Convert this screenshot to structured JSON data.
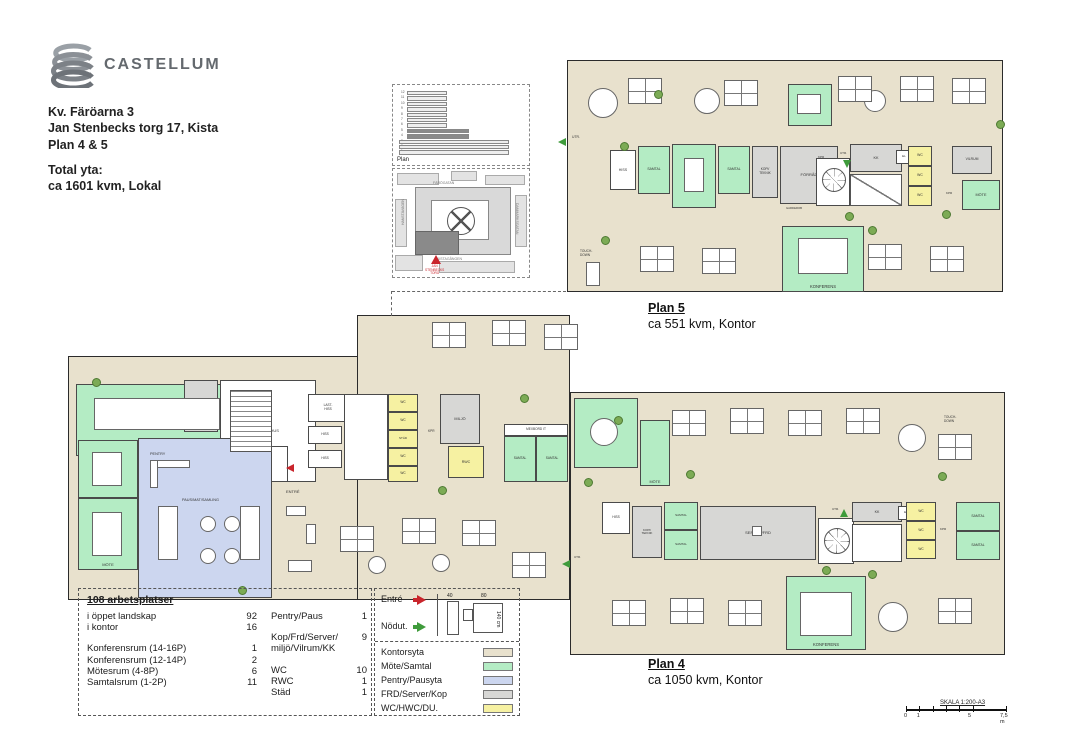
{
  "brand": {
    "name": "CASTELLUM"
  },
  "header": {
    "line1": "Kv. Färöarna 3",
    "line2": "Jan Stenbecks torg 17, Kista",
    "line3": "Plan 4 & 5",
    "total_label": "Total yta:",
    "total_value": "ca 1601 kvm, Lokal"
  },
  "palette": {
    "kontor": "#e8e1cd",
    "mote": "#b4ecc4",
    "pentry": "#ccd6ef",
    "frd": "#d7d7d5",
    "wc": "#f6f1a2",
    "white": "#ffffff",
    "wall": "#2b2b2b",
    "roomline": "#4a4a4a",
    "plant": "#7cab55",
    "red": "#c9252c",
    "green": "#3f9b3b"
  },
  "site": {
    "elevation_label": "Plan",
    "floors": [
      "12",
      "11",
      "10",
      "9",
      "8",
      "7",
      "6",
      "5",
      "4",
      "3",
      "2",
      "1"
    ],
    "streets": {
      "top": "FÄRÖGATAN",
      "bottom": "KISTAGÅNGEN",
      "left": "HANSTAVÄGEN",
      "right": "DANMARKSGATAN"
    },
    "marker": "JAN\nSTENBECKS\nTORG"
  },
  "plan5": {
    "title": "Plan 5",
    "subtitle": "ca 551 kvm, Kontor",
    "shapes": [
      [
        567,
        60,
        436,
        232,
        "kontor"
      ]
    ],
    "dashes": [],
    "rooms": [
      [
        788,
        84,
        44,
        42,
        "mote",
        "MÖTE",
        4
      ],
      [
        610,
        150,
        26,
        40,
        "white",
        "HISS",
        3.6
      ],
      [
        638,
        146,
        32,
        48,
        "mote",
        "SAMTAL",
        3.4
      ],
      [
        672,
        144,
        44,
        64,
        "mote",
        "MÖTE",
        4
      ],
      [
        718,
        146,
        32,
        48,
        "mote",
        "SAMTAL",
        3.4
      ],
      [
        752,
        146,
        26,
        52,
        "frd",
        "KOPI/\nTEKNIK",
        3.2
      ],
      [
        780,
        146,
        58,
        58,
        "frd",
        "FÖRRÅD",
        4
      ],
      [
        850,
        144,
        52,
        28,
        "frd",
        "KK",
        3.8
      ],
      [
        896,
        150,
        16,
        14,
        "white",
        "EL",
        3
      ],
      [
        908,
        146,
        24,
        20,
        "wc",
        "WC",
        3.4
      ],
      [
        908,
        166,
        24,
        20,
        "wc",
        "WC",
        3.4
      ],
      [
        908,
        186,
        24,
        20,
        "wc",
        "WC",
        3.4
      ],
      [
        952,
        146,
        40,
        28,
        "frd",
        "VILRUM",
        3.4
      ],
      [
        962,
        180,
        38,
        30,
        "mote",
        "MÖTE",
        3.8
      ],
      [
        782,
        226,
        82,
        66,
        "mote",
        "KONFERENS",
        4.2,
        "b"
      ],
      [
        816,
        158,
        34,
        48,
        "white",
        "",
        0
      ]
    ],
    "furn": [
      [
        798,
        238,
        50,
        36,
        "rect"
      ],
      [
        684,
        158,
        20,
        34,
        "rect"
      ],
      [
        797,
        94,
        24,
        20,
        "rect"
      ],
      [
        588,
        88,
        30,
        30,
        "round"
      ],
      [
        694,
        88,
        26,
        26,
        "round"
      ],
      [
        864,
        90,
        22,
        22,
        "round"
      ],
      [
        822,
        168,
        24,
        24,
        "spiral"
      ],
      [
        850,
        174,
        52,
        32,
        "diag"
      ],
      [
        628,
        78,
        0,
        0,
        "cluster"
      ],
      [
        724,
        80,
        0,
        0,
        "cluster"
      ],
      [
        838,
        76,
        0,
        0,
        "cluster"
      ],
      [
        900,
        76,
        0,
        0,
        "cluster"
      ],
      [
        952,
        78,
        0,
        0,
        "cluster"
      ],
      [
        640,
        246,
        0,
        0,
        "cluster"
      ],
      [
        702,
        248,
        0,
        0,
        "cluster"
      ],
      [
        868,
        244,
        0,
        0,
        "cluster"
      ],
      [
        930,
        246,
        0,
        0,
        "cluster"
      ],
      [
        586,
        262,
        14,
        24,
        "rect"
      ]
    ],
    "texts": [
      [
        572,
        136,
        "UTR.",
        3.4
      ],
      [
        818,
        156,
        "KPR",
        3
      ],
      [
        840,
        152,
        "UTR.",
        3
      ],
      [
        946,
        192,
        "KPR",
        3
      ],
      [
        786,
        207,
        "GARDEROB",
        2.8
      ],
      [
        580,
        250,
        "TOUCH-\nDOWN",
        3.2
      ]
    ],
    "arrows": [
      [
        558,
        138,
        "left",
        "green"
      ],
      [
        843,
        160,
        "down",
        "green"
      ]
    ],
    "plants": [
      [
        620,
        142
      ],
      [
        654,
        90
      ],
      [
        845,
        212
      ],
      [
        868,
        226
      ],
      [
        942,
        210
      ],
      [
        601,
        236
      ],
      [
        996,
        120
      ]
    ]
  },
  "plan4": {
    "title": "Plan 4",
    "subtitle": "ca 1050 kvm, Kontor",
    "shapes": [
      [
        68,
        356,
        352,
        244,
        "kontor"
      ],
      [
        357,
        315,
        213,
        285,
        "kontor"
      ],
      [
        570,
        392,
        435,
        263,
        "kontor"
      ]
    ],
    "dashes": [
      [
        392,
        291,
        174,
        "h"
      ],
      [
        391,
        291,
        25,
        "v"
      ]
    ],
    "rooms": [
      [
        76,
        384,
        162,
        72,
        "mote",
        "KONFERENS",
        4.2,
        "b"
      ],
      [
        184,
        380,
        34,
        52,
        "frd",
        "FÖRRÅD",
        3.2
      ],
      [
        220,
        380,
        96,
        102,
        "white",
        "TRAPPHUS",
        4
      ],
      [
        232,
        446,
        56,
        36,
        "white",
        "ELC",
        3.8
      ],
      [
        78,
        440,
        60,
        58,
        "mote",
        "MÖTE",
        4
      ],
      [
        78,
        498,
        60,
        72,
        "mote",
        "MÖTE",
        4,
        "b"
      ],
      [
        138,
        438,
        134,
        160,
        "pentry",
        "",
        0
      ],
      [
        308,
        394,
        40,
        28,
        "white",
        "LAST-\nHISS",
        3.2
      ],
      [
        308,
        426,
        34,
        18,
        "white",
        "HISS",
        3.2
      ],
      [
        308,
        450,
        34,
        18,
        "white",
        "HISS",
        3.2
      ],
      [
        344,
        394,
        44,
        86,
        "white",
        "",
        0
      ],
      [
        388,
        394,
        30,
        18,
        "wc",
        "WC",
        3.2
      ],
      [
        388,
        412,
        30,
        18,
        "wc",
        "WC",
        3.2
      ],
      [
        388,
        430,
        30,
        18,
        "wc",
        "STÄD",
        3
      ],
      [
        388,
        448,
        30,
        18,
        "wc",
        "WC",
        3.2
      ],
      [
        388,
        466,
        30,
        16,
        "wc",
        "WC",
        3.2
      ],
      [
        440,
        394,
        40,
        50,
        "frd",
        "MILJÖ",
        3.8
      ],
      [
        448,
        446,
        36,
        32,
        "wc",
        "RWC",
        3.6
      ],
      [
        504,
        424,
        64,
        12,
        "white",
        "MEXBORD IT",
        3.2
      ],
      [
        504,
        436,
        32,
        46,
        "mote",
        "SAMTAL",
        3.2
      ],
      [
        536,
        436,
        32,
        46,
        "mote",
        "SAMTAL",
        3.2
      ],
      [
        574,
        398,
        64,
        70,
        "mote",
        "MÖTE",
        4
      ],
      [
        640,
        420,
        30,
        66,
        "mote",
        "MÖTE",
        3.8,
        "b"
      ],
      [
        602,
        502,
        28,
        32,
        "white",
        "HISS",
        3.2
      ],
      [
        632,
        506,
        30,
        52,
        "frd",
        "KOPI/\nTEKNIK",
        3
      ],
      [
        664,
        502,
        34,
        28,
        "mote",
        "SAMTAL",
        3
      ],
      [
        664,
        530,
        34,
        30,
        "mote",
        "SAMTAL",
        3
      ],
      [
        700,
        506,
        116,
        54,
        "frd",
        "SERVER/FRD",
        4
      ],
      [
        818,
        518,
        36,
        46,
        "white",
        "",
        0
      ],
      [
        852,
        502,
        50,
        20,
        "frd",
        "KK",
        3.6
      ],
      [
        852,
        524,
        50,
        38,
        "white",
        "",
        0
      ],
      [
        898,
        506,
        16,
        14,
        "white",
        "EL",
        3
      ],
      [
        906,
        502,
        30,
        19,
        "wc",
        "WC",
        3.2
      ],
      [
        906,
        521,
        30,
        19,
        "wc",
        "WC",
        3.2
      ],
      [
        906,
        540,
        30,
        19,
        "wc",
        "WC",
        3.2
      ],
      [
        956,
        502,
        44,
        29,
        "mote",
        "SAMTAL",
        3.4
      ],
      [
        956,
        531,
        44,
        29,
        "mote",
        "SAMTAL",
        3.4
      ],
      [
        786,
        576,
        80,
        74,
        "mote",
        "KONFERENS",
        4.2,
        "b"
      ]
    ],
    "furn": [
      [
        94,
        398,
        126,
        32,
        "rect"
      ],
      [
        92,
        452,
        30,
        34,
        "rect"
      ],
      [
        92,
        512,
        30,
        44,
        "rect"
      ],
      [
        230,
        390,
        42,
        62,
        "stair"
      ],
      [
        150,
        460,
        40,
        8,
        "rect"
      ],
      [
        150,
        460,
        8,
        28,
        "rect"
      ],
      [
        158,
        506,
        20,
        54,
        "rect"
      ],
      [
        240,
        506,
        20,
        54,
        "rect"
      ],
      [
        200,
        516,
        16,
        16,
        "round"
      ],
      [
        224,
        516,
        16,
        16,
        "round"
      ],
      [
        200,
        548,
        16,
        16,
        "round"
      ],
      [
        224,
        548,
        16,
        16,
        "round"
      ],
      [
        286,
        506,
        20,
        10,
        "rect"
      ],
      [
        306,
        524,
        10,
        20,
        "rect"
      ],
      [
        288,
        560,
        24,
        12,
        "rect"
      ],
      [
        432,
        322,
        0,
        0,
        "cluster"
      ],
      [
        492,
        320,
        0,
        0,
        "cluster"
      ],
      [
        544,
        324,
        0,
        0,
        "cluster"
      ],
      [
        340,
        526,
        0,
        0,
        "cluster"
      ],
      [
        402,
        518,
        0,
        0,
        "cluster"
      ],
      [
        462,
        520,
        0,
        0,
        "cluster"
      ],
      [
        512,
        552,
        0,
        0,
        "cluster"
      ],
      [
        368,
        556,
        18,
        18,
        "round"
      ],
      [
        432,
        554,
        18,
        18,
        "round"
      ],
      [
        590,
        418,
        28,
        28,
        "round"
      ],
      [
        672,
        410,
        0,
        0,
        "cluster"
      ],
      [
        730,
        408,
        0,
        0,
        "cluster"
      ],
      [
        788,
        410,
        0,
        0,
        "cluster"
      ],
      [
        846,
        408,
        0,
        0,
        "cluster"
      ],
      [
        898,
        424,
        28,
        28,
        "round"
      ],
      [
        938,
        434,
        0,
        0,
        "cluster"
      ],
      [
        824,
        528,
        26,
        26,
        "spiral"
      ],
      [
        752,
        526,
        10,
        10,
        "rect"
      ],
      [
        800,
        592,
        52,
        44,
        "rect"
      ],
      [
        612,
        600,
        0,
        0,
        "cluster"
      ],
      [
        670,
        598,
        0,
        0,
        "cluster"
      ],
      [
        728,
        600,
        0,
        0,
        "cluster"
      ],
      [
        938,
        598,
        0,
        0,
        "cluster"
      ],
      [
        878,
        602,
        30,
        30,
        "round"
      ]
    ],
    "texts": [
      [
        150,
        452,
        "PENTRY",
        3.8
      ],
      [
        182,
        498,
        "PAUS/MAT/SAMLING",
        3.8
      ],
      [
        286,
        490,
        "ENTRÉ",
        4
      ],
      [
        428,
        430,
        "KPR",
        3.2
      ],
      [
        832,
        508,
        "UTR.",
        3
      ],
      [
        940,
        528,
        "KPR",
        3
      ],
      [
        574,
        556,
        "UTR.",
        3
      ],
      [
        944,
        416,
        "TOUCH-\nDOWN",
        3.2
      ]
    ],
    "arrows": [
      [
        286,
        464,
        "left",
        "red"
      ],
      [
        840,
        509,
        "up",
        "green"
      ],
      [
        562,
        560,
        "left",
        "green"
      ]
    ],
    "plants": [
      [
        92,
        378
      ],
      [
        238,
        586
      ],
      [
        438,
        486
      ],
      [
        520,
        394
      ],
      [
        584,
        478
      ],
      [
        686,
        470
      ],
      [
        822,
        566
      ],
      [
        868,
        570
      ],
      [
        938,
        472
      ],
      [
        614,
        416
      ]
    ]
  },
  "stats": {
    "title": "108 arbetsplatser",
    "left_rows": [
      {
        "label": "i öppet landskap",
        "value": "92"
      },
      {
        "label": "i kontor",
        "value": "16"
      },
      null,
      {
        "label": "Konferensrum (14-16P)",
        "value": "1"
      },
      {
        "label": "Konferensrum (12-14P)",
        "value": "2"
      },
      {
        "label": "Mötesrum (4-8P)",
        "value": "6"
      },
      {
        "label": "Samtalsrum (1-2P)",
        "value": "11"
      }
    ],
    "right_rows": [
      {
        "label": "Pentry/Paus",
        "value": "1"
      },
      null,
      {
        "label": "Kop/Frd/Server/\nmiljö/Vilrum/KK",
        "value": "9"
      },
      null,
      {
        "label": "WC",
        "value": "10"
      },
      {
        "label": "RWC",
        "value": "1"
      },
      {
        "label": "Städ",
        "value": "1"
      }
    ]
  },
  "legend": {
    "entre_label": "Entré",
    "nodut_label": "Nödut.",
    "door_dims": {
      "w1": "40",
      "w2": "80",
      "h": "140 cm"
    },
    "colors": [
      {
        "label": "Kontorsyta",
        "key": "kontor"
      },
      {
        "label": "Möte/Samtal",
        "key": "mote"
      },
      {
        "label": "Pentry/Pausyta",
        "key": "pentry"
      },
      {
        "label": "FRD/Server/Kop",
        "key": "frd"
      },
      {
        "label": "WC/HWC/DU.",
        "key": "wc"
      }
    ]
  },
  "scalebar": {
    "label": "SKALA 1:200-A3",
    "ticks": [
      {
        "pos": 0,
        "text": "0"
      },
      {
        "pos": 0.133,
        "text": "1"
      },
      {
        "pos": 0.667,
        "text": "5"
      },
      {
        "pos": 1,
        "text": "7,5 m"
      }
    ]
  }
}
